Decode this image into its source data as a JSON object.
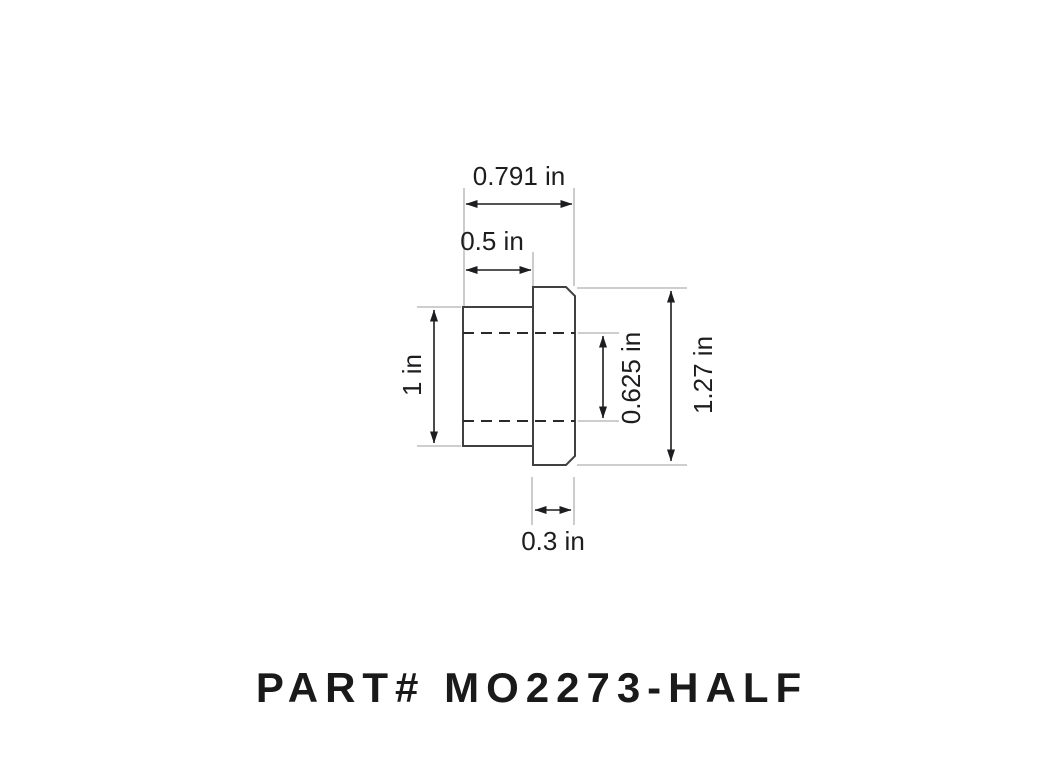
{
  "title": {
    "part_label": "PART# MO2273-HALF"
  },
  "drawing": {
    "units": "in",
    "dimensions": {
      "overall_width": {
        "label": "0.791 in",
        "value": 0.791
      },
      "body_width": {
        "label": "0.5 in",
        "value": 0.5
      },
      "body_height": {
        "label": "1 in",
        "value": 1
      },
      "bore_height": {
        "label": "0.625 in",
        "value": 0.625
      },
      "flange_height": {
        "label": "1.27 in",
        "value": 1.27
      },
      "flange_width": {
        "label": "0.3 in",
        "value": 0.3
      }
    },
    "colors": {
      "background": "#ffffff",
      "outline": "#404040",
      "dimension": "#1d1d1f",
      "extension": "#aeb0b3",
      "centerline": "#2a2a2a",
      "title_text": "#1a1a1a"
    }
  }
}
